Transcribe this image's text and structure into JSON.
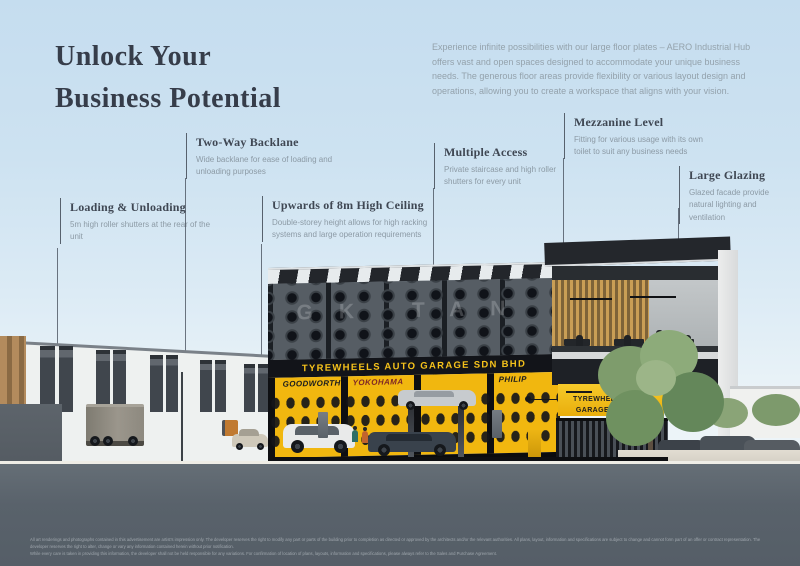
{
  "page": {
    "title_line1": "Unlock Your",
    "title_line2": "Business Potential",
    "intro": "Experience infinite possibilities with our large floor plates – AERO Industrial Hub offers vast and open spaces designed to accommodate your unique business needs. The generous floor areas provide flexibility or various layout design and operations, allowing you to create a workspace that aligns with your vision."
  },
  "callouts": [
    {
      "title": "Loading & Unloading",
      "body": "5m high roller shutters at the rear of the unit"
    },
    {
      "title": "Two-Way Backlane",
      "body": "Wide backlane for ease of loading and unloading purposes"
    },
    {
      "title": "Upwards of 8m High Ceiling",
      "body": "Double-storey height allows for high racking systems and large operation requirements"
    },
    {
      "title": "Multiple Access",
      "body": "Private staircase and high roller shutters for every unit"
    },
    {
      "title": "Mezzanine Level",
      "body": "Fitting for various usage with its own toilet to suit any business needs"
    },
    {
      "title": "Large Glazing",
      "body": "Glazed facade provide natural lighting and ventilation"
    }
  ],
  "building": {
    "main_sign": "TYREWHEELS AUTO GARAGE SDN BHD",
    "side_sign_line1": "TYREWHEELS AUTO",
    "side_sign_line2": "GARAGE SDN BHD",
    "watermark": "GK TAN",
    "brands": [
      "GOODWORTH",
      "YOKOHAMA",
      "PHILIP"
    ]
  },
  "colors": {
    "accent_yellow": "#F1B70F",
    "sign_yellow": "#F5C21B",
    "sky": "#C5DDEF",
    "road": "#59626B",
    "title_text": "#363D4A"
  },
  "disclaimer": {
    "line1": "All art renderings and photographs contained in this advertisement are artist's impression only. The developer reserves the right to modify any part or parts of the building prior to completion as directed or approved by the architects and/or the relevant authorities. All plans, layout, information and specifications are subject to change and cannot form part of an offer or contract representation. The developer reserves the right to alter, change or vary any information contained herein without prior notification.",
    "line2": "While every care is taken in providing this information, the developer shall not be held responsible for any variations. For confirmation of location of plans, layouts, information and specifications, please always refer to the Sales and Purchase Agreement."
  }
}
